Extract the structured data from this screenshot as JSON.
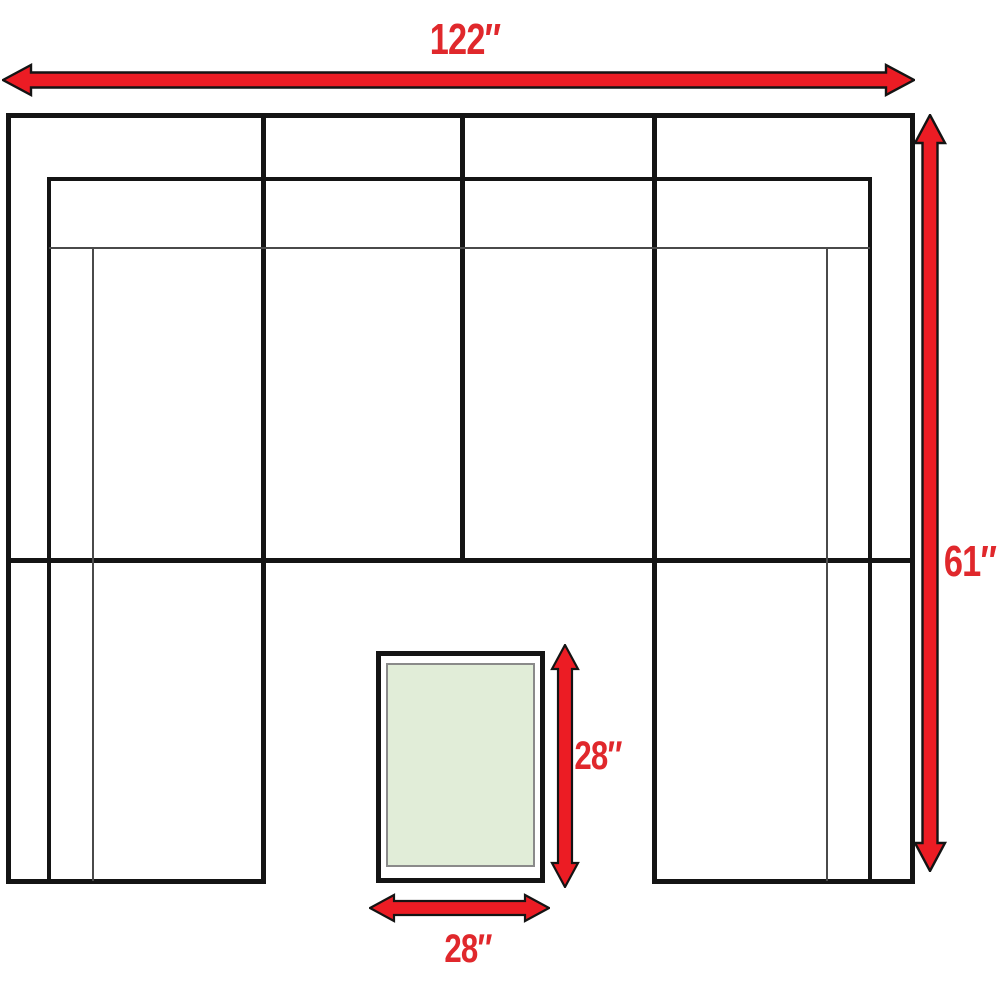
{
  "diagram": {
    "name": "sectional-sofa-floorplan-dimensions",
    "dimension_annotations": [
      {
        "id": "overall-width",
        "label": "122″",
        "orientation": "horizontal"
      },
      {
        "id": "overall-depth",
        "label": "61″",
        "orientation": "vertical"
      },
      {
        "id": "ottoman-depth",
        "label": "28″",
        "orientation": "vertical"
      },
      {
        "id": "ottoman-width",
        "label": "28″",
        "orientation": "horizontal"
      }
    ]
  },
  "colors": {
    "line_black": "#141414",
    "thin_gray": "#4a4a4a",
    "arrow_red": "#ec1c24",
    "label_red": "#e0282c",
    "ottoman_fill": "#e1edd8",
    "ottoman_border": "#8a8a8a",
    "background": "#ffffff"
  }
}
